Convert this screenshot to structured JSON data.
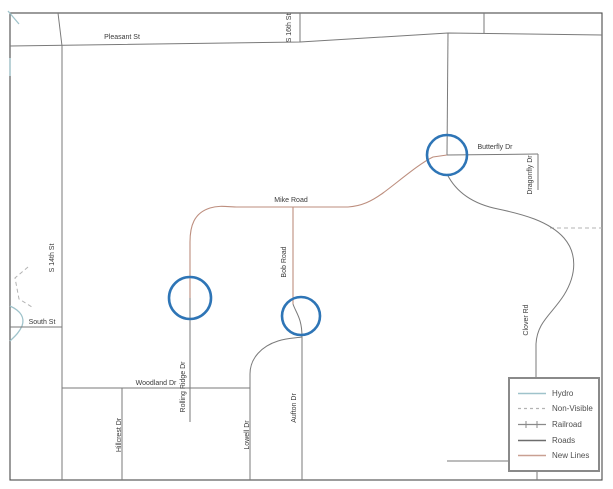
{
  "colors": {
    "road": "#7a7a7a",
    "new_line": "#bd8e7e",
    "hydro": "#9fc3cb",
    "non_visible": "#b3b3b3",
    "highlight": "#2e75b6",
    "frame": "#4a4a4a",
    "label_text": "#3a3a3a",
    "legend_border": "#8a8a8a"
  },
  "map": {
    "street_labels": {
      "pleasant_st": "Pleasant St",
      "s_16th_st": "S 16th St",
      "s_14th_st": "S 14th St",
      "south_st": "South St",
      "mike_road": "Mike Road",
      "bob_road": "Bob Road",
      "butterfly_dr": "Butterfly Dr",
      "dragonfly_dr": "Dragonfly Dr",
      "clover_rd": "Clover Rd",
      "woodland_dr": "Woodland Dr",
      "rolling_ridge_dr": "Rolling Ridge Dr",
      "hillcrest_dr": "Hillcrest Dr",
      "lowell_dr": "Lowell Dr",
      "aufton_dr": "Aufton Dr"
    }
  },
  "legend": {
    "items": [
      {
        "label": "Hydro"
      },
      {
        "label": "Non-Visible"
      },
      {
        "label": "Railroad"
      },
      {
        "label": "Roads"
      },
      {
        "label": "New Lines"
      }
    ]
  }
}
